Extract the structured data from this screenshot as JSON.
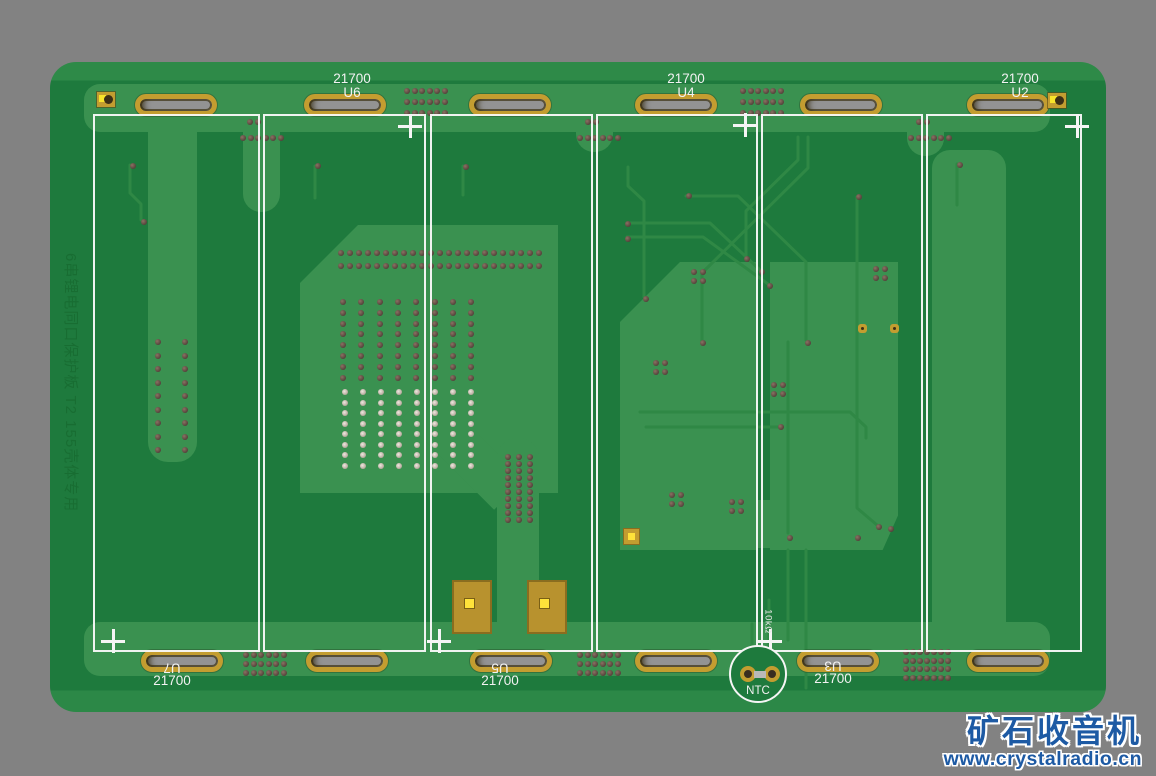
{
  "background_color": "#828282",
  "board": {
    "type": "pcb-3d-render",
    "solder_mask_color": "#1e7a3d",
    "copper_pour_color": "#3a9150",
    "pad_gold_color": "#c39d30",
    "outline_color": "#f5f5f5",
    "silkscreen_note": "6串锂电同口保护板 T2 155壳体专用",
    "cells": [
      {
        "refdes": "U7",
        "size": "21700"
      },
      {
        "refdes": "U6",
        "size": "21700"
      },
      {
        "refdes": "U5",
        "size": "21700"
      },
      {
        "refdes": "U4",
        "size": "21700"
      },
      {
        "refdes": "U3",
        "size": "21700"
      },
      {
        "refdes": "U2",
        "size": "21700"
      }
    ],
    "ntc": {
      "label": "NTC",
      "value": "10kΩ"
    }
  },
  "watermark": {
    "site_name": "矿石收音机",
    "site_url": "www.crystalradio.cn",
    "color": "#1d5aa4"
  }
}
